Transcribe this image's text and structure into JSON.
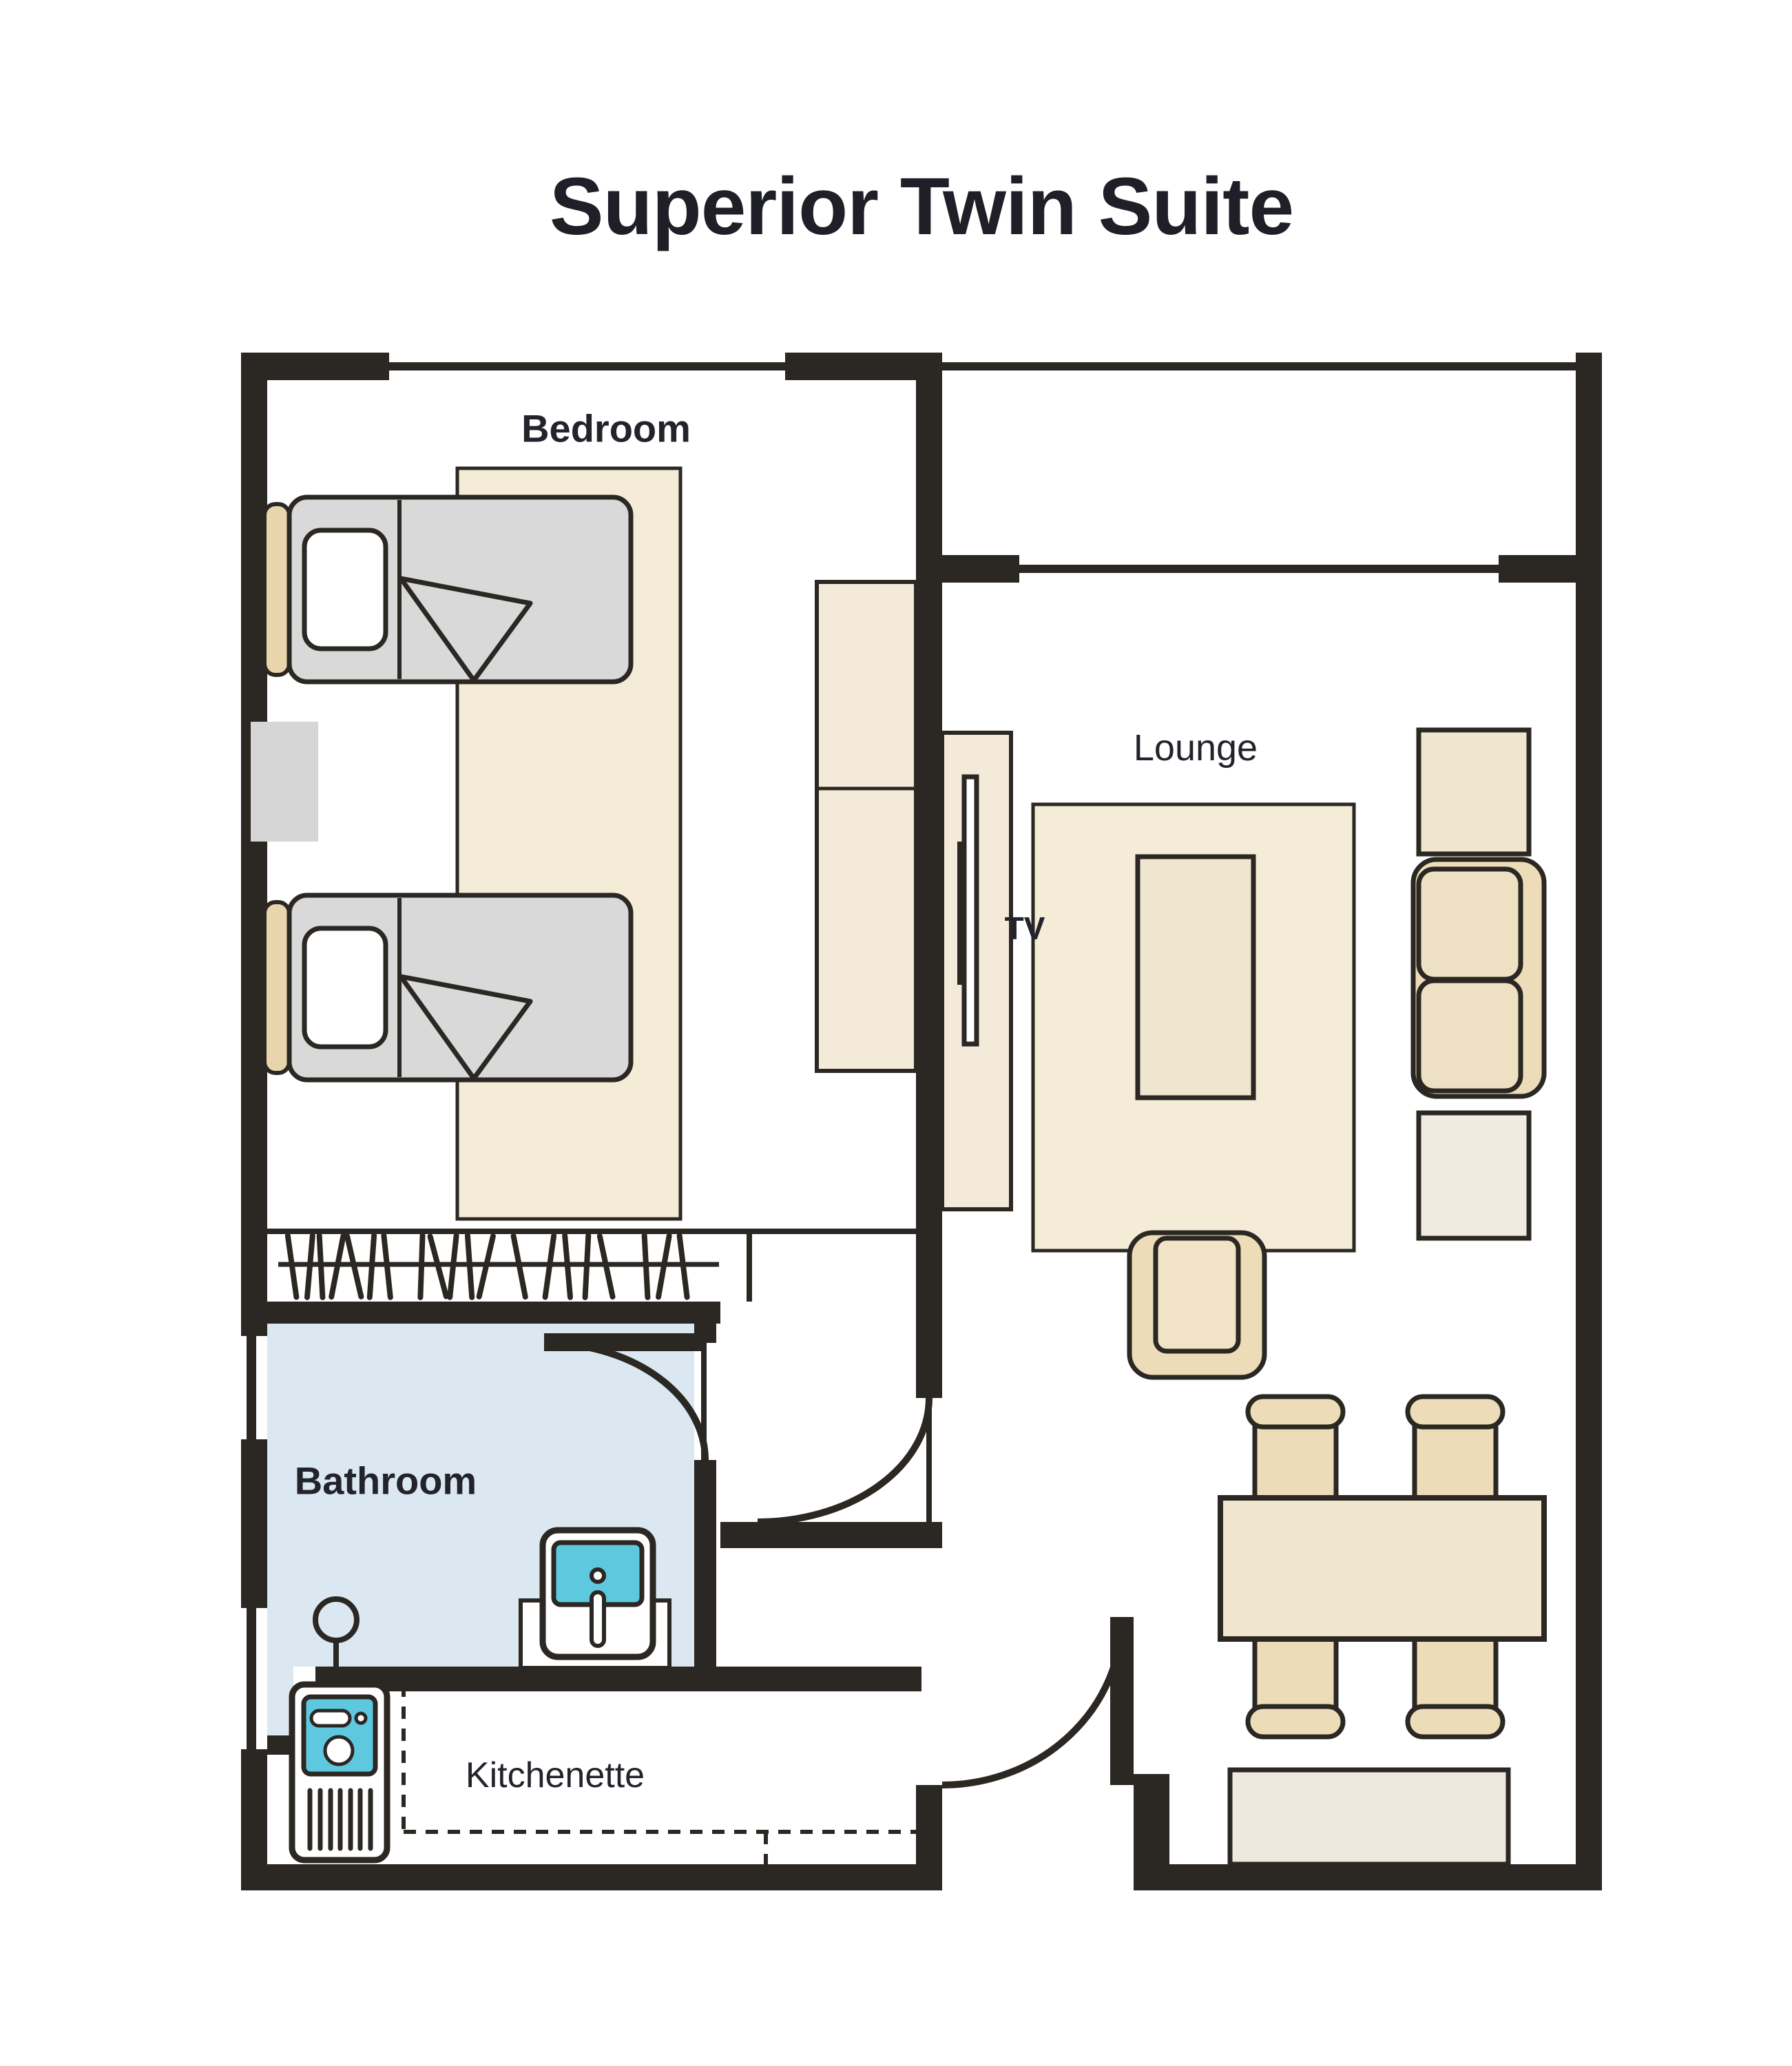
{
  "title": "Superior Twin Suite",
  "rooms": {
    "bedroom": "Bedroom",
    "lounge": "Lounge",
    "bathroom": "Bathroom",
    "kitchenette": "Kitchenette"
  },
  "tv_label": "TV",
  "colors": {
    "wall": "#2b2723",
    "furniture_beige": "#ecdcb8",
    "rug_beige": "#f5ecd8",
    "table_beige": "#f0e6d0",
    "bench_beige": "#efe9dd",
    "bed_gray": "#d9d9d9",
    "bathroom_floor": "#dbe8f1",
    "fixture_cyan": "#5ec9de",
    "text": "#23232b"
  }
}
